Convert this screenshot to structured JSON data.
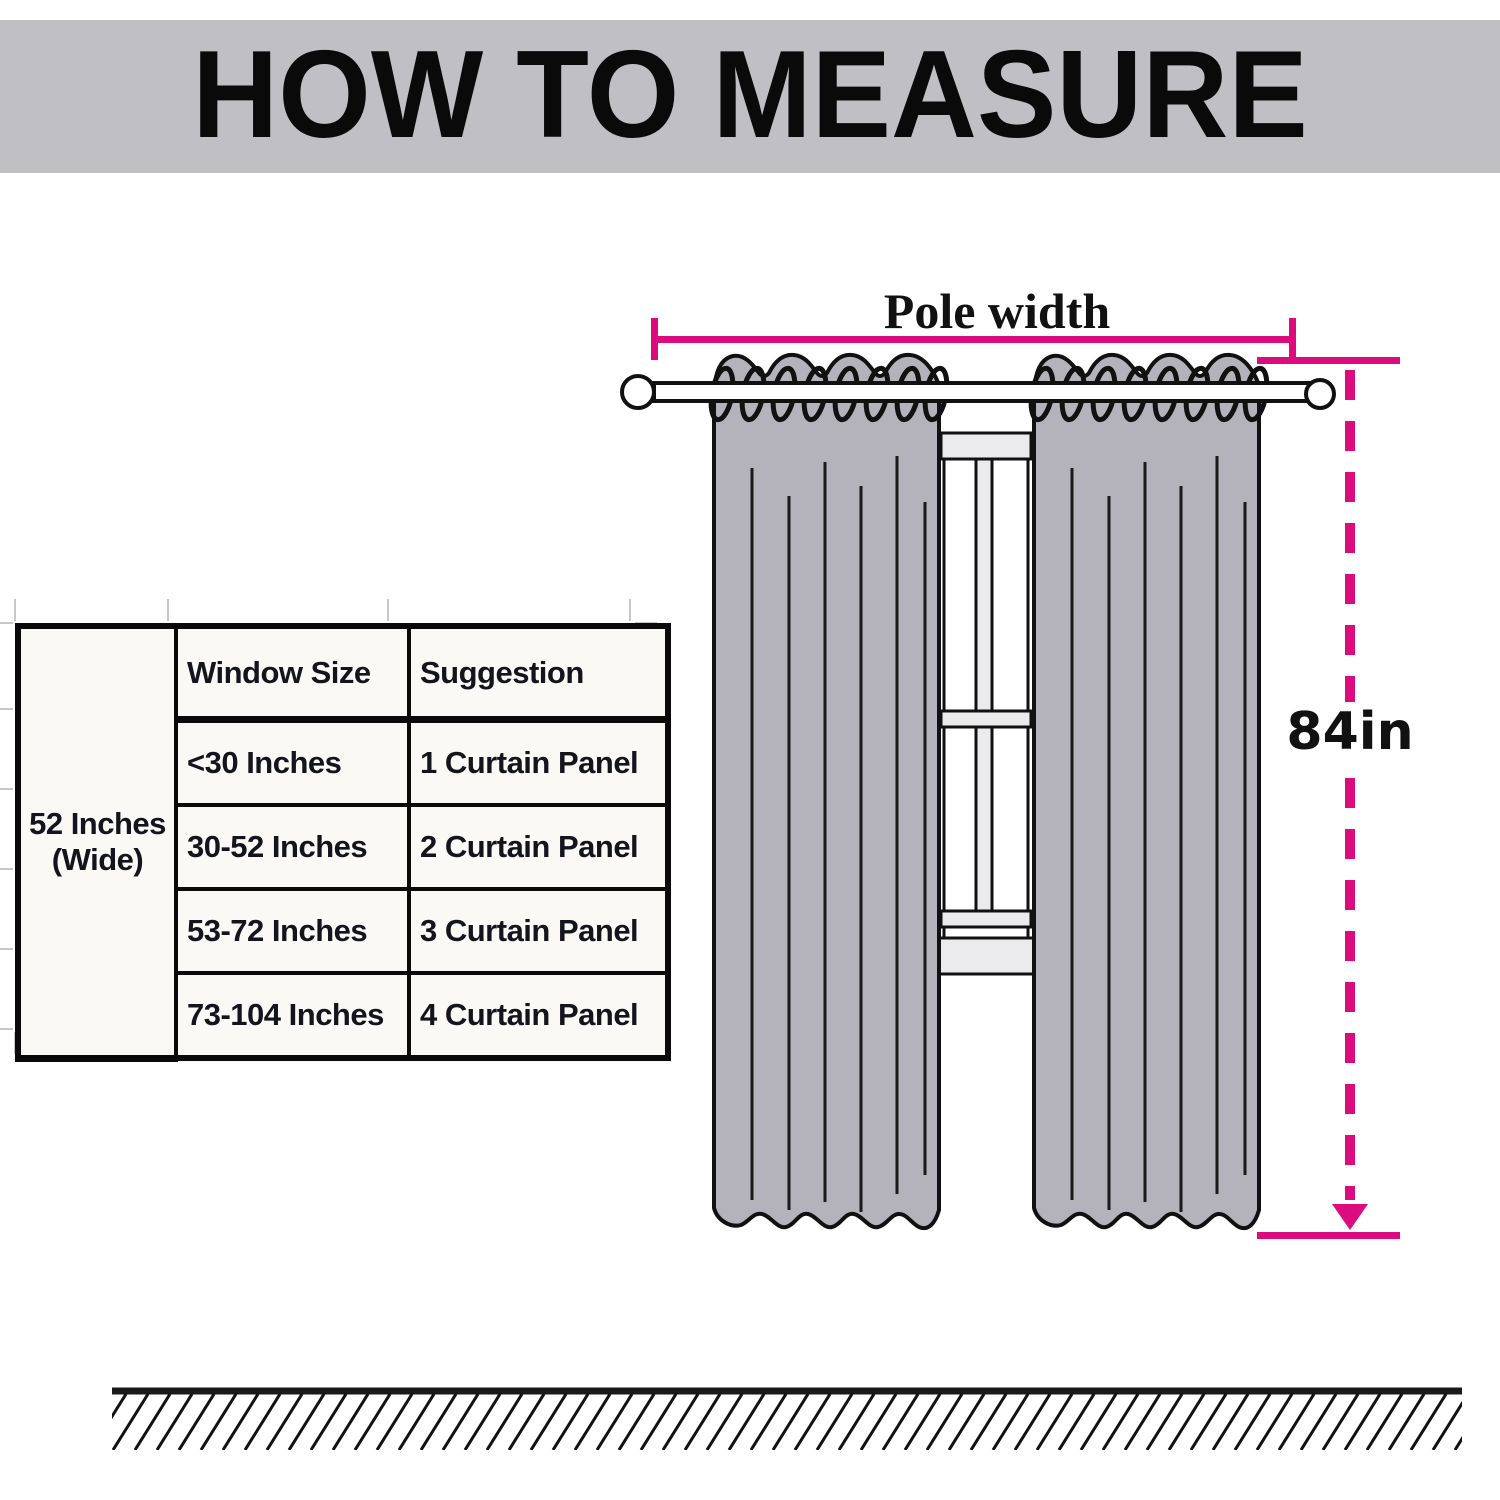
{
  "header": {
    "title": "HOW TO MEASURE"
  },
  "diagram": {
    "pole_width_label": "Pole width",
    "height_label": "84in",
    "colors": {
      "measure_pink": "#dc0c7f",
      "curtain_gray": "#b4b3bb",
      "banner_gray": "#c0c0c4",
      "window_fill": "#ebebed",
      "outline_black": "#111111"
    }
  },
  "size_table": {
    "span_label": {
      "line1": "52 Inches",
      "line2": "(Wide)"
    },
    "col_headers": {
      "window_size": "Window Size",
      "suggestion": "Suggestion"
    },
    "rows": [
      {
        "window_size": "<30 Inches",
        "suggestion": "1 Curtain Panel"
      },
      {
        "window_size": "30-52 Inches",
        "suggestion": "2 Curtain Panel"
      },
      {
        "window_size": "53-72 Inches",
        "suggestion": "3 Curtain Panel"
      },
      {
        "window_size": "73-104 Inches",
        "suggestion": "4 Curtain Panel"
      }
    ]
  }
}
